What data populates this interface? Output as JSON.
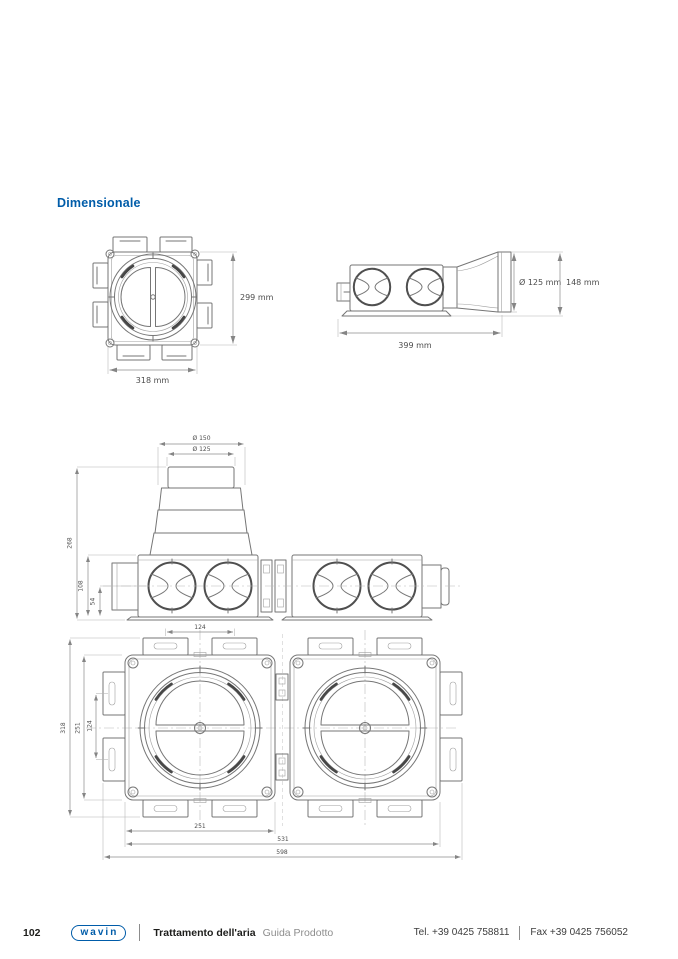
{
  "page": {
    "title": "Dimensionale"
  },
  "theme": {
    "accent": "#005CA9"
  },
  "front_view": {
    "dim_height": "299 mm",
    "dim_width": "318 mm"
  },
  "side_view": {
    "dim_diameter": "Ø 125 mm",
    "dim_total_height": "148 mm",
    "dim_length": "399 mm"
  },
  "assembly_side": {
    "dim_outer_diameter": "Ø 150",
    "dim_inner_diameter": "Ø 125",
    "dim_total_height": "268",
    "dim_body_height": "108",
    "dim_axis_height": "54"
  },
  "assembly_top": {
    "dim_port_spacing_top": "124",
    "dim_overall_depth": "318",
    "dim_body_depth": "251",
    "dim_port_spacing_side": "124",
    "dim_body_width": "251",
    "dim_double_width": "531",
    "dim_overall_width": "598"
  },
  "footer": {
    "page_number": "102",
    "brand": "wavin",
    "doc_title": "Trattamento dell'aria",
    "doc_subtitle": "Guida Prodotto",
    "phone": "Tel.  +39 0425 758811",
    "fax": "Fax +39 0425 756052"
  }
}
